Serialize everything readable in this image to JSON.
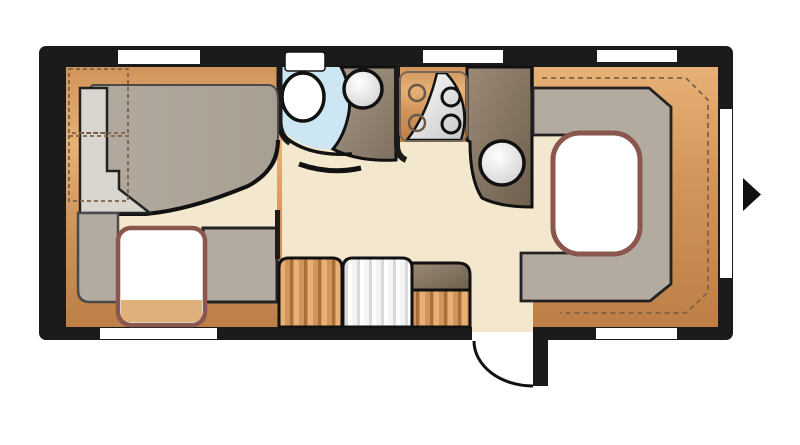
{
  "diagram": {
    "kind": "caravan-floorplan",
    "features": {
      "windows_top": 3,
      "windows_bottom": 2,
      "windows_side": 1,
      "entrance_door": 1,
      "direction_arrow": 1,
      "bed_pillow_sections": 2,
      "overhead_locker_outlines_left": 2,
      "washroom_toilet": 1,
      "washroom_basin": 1,
      "kitchen_hob_burners": 4,
      "kitchen_sink": 1,
      "front_dinette_benches": 2,
      "front_dinette_table": 1,
      "rear_dinette_u_seat": 1,
      "rear_dinette_table": 1,
      "lower_cabinets": 3
    }
  },
  "colors": {
    "wall": "#1b1b1b",
    "white": "#ffffff",
    "floor": "#f3e8cd",
    "bath_floor": "#cde6f3",
    "wood_light": "#e7b176",
    "wood_mid": "#d1945a",
    "wood_dark": "#bd7f45",
    "wood_deep": "#a96f38",
    "cushion": "#b4aba0",
    "cushion_dark": "#a89f93",
    "pillow": "#d9d6cf",
    "counter_light": "#9b8a76",
    "counter_dark": "#6e5f4e",
    "vanity_light": "#a8998a",
    "vanity_dark": "#7e6f5e",
    "steel_light": "#ffffff",
    "steel_dark": "#c7c7c7",
    "table_border": "#8a564e",
    "table_wood_tint": "#dba76a",
    "outline": "#222222",
    "outline_gray": "#6d6d6d",
    "dash_wood": "#7d6144",
    "dash_gray": "#555555"
  }
}
